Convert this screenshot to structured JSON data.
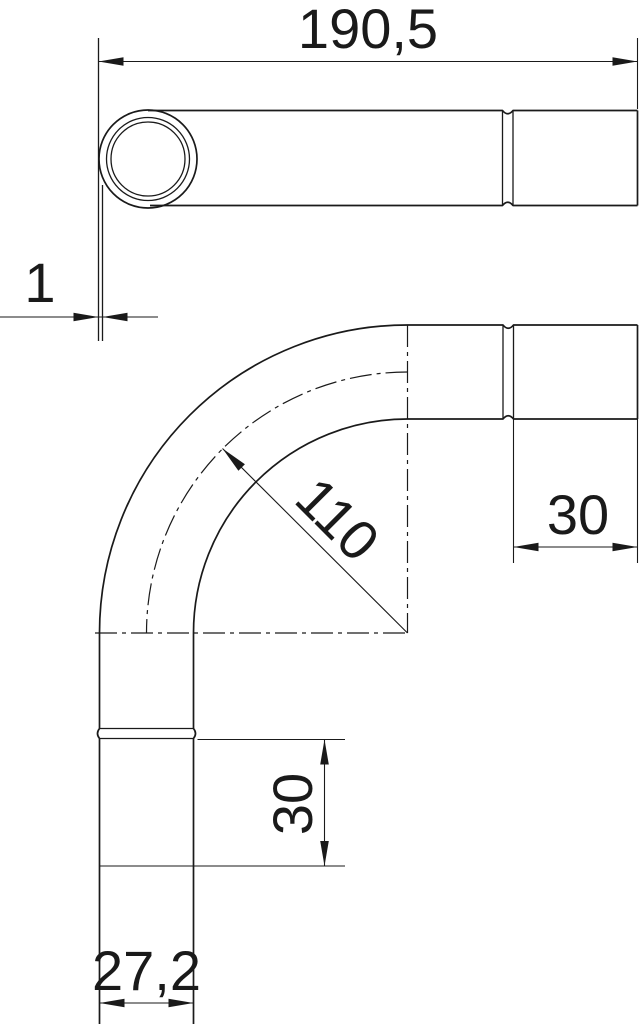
{
  "drawing": {
    "type": "technical-drawing",
    "subject": "conduit-bend-with-socket",
    "colors": {
      "background": "#ffffff",
      "line": "#1a1a1a"
    },
    "dimensions": {
      "overall_length": "190,5",
      "wall_thickness": "1",
      "bend_radius": "110",
      "socket_length_side": "30",
      "socket_length_bottom": "30",
      "outer_diameter": "27,2"
    }
  }
}
